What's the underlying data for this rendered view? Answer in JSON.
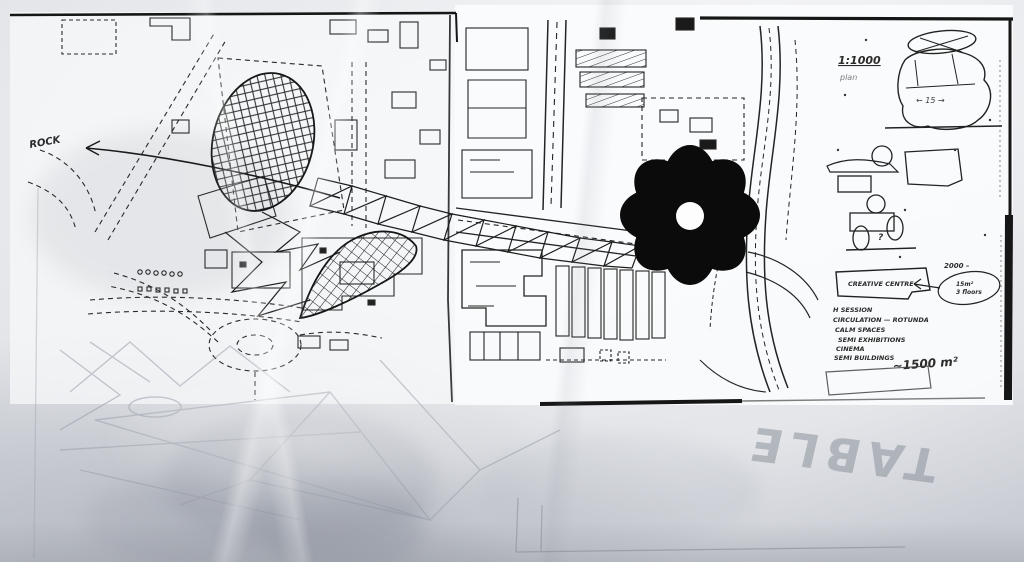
{
  "photo": {
    "description": "architect concept sketch over photocopied street map",
    "annotations": {
      "rock_label": "ROCK",
      "table_watermark": "TABLE"
    },
    "side_panel": {
      "scale_label": "1:1000",
      "scale_sublabel": "plan",
      "rock_dimension": "← 15 →",
      "question_mark": "?",
      "centre_box_label": "CREATIVE CENTRE",
      "capacity_note": "2000 –",
      "bubble_line1": "15m²",
      "bubble_line2": "3 floors",
      "programme": [
        "H  SESSION",
        "CIRCULATION — ROTUNDA",
        "CALM  SPACES",
        "SEMI  EXHIBITIONS",
        "CINEMA",
        "SEMI  BUILDINGS"
      ],
      "area_estimate": "~1500 m²"
    },
    "colors": {
      "ink": "#1c1c1c",
      "pencil": "#9aa0ab",
      "paper": "#f6f7f8"
    }
  }
}
